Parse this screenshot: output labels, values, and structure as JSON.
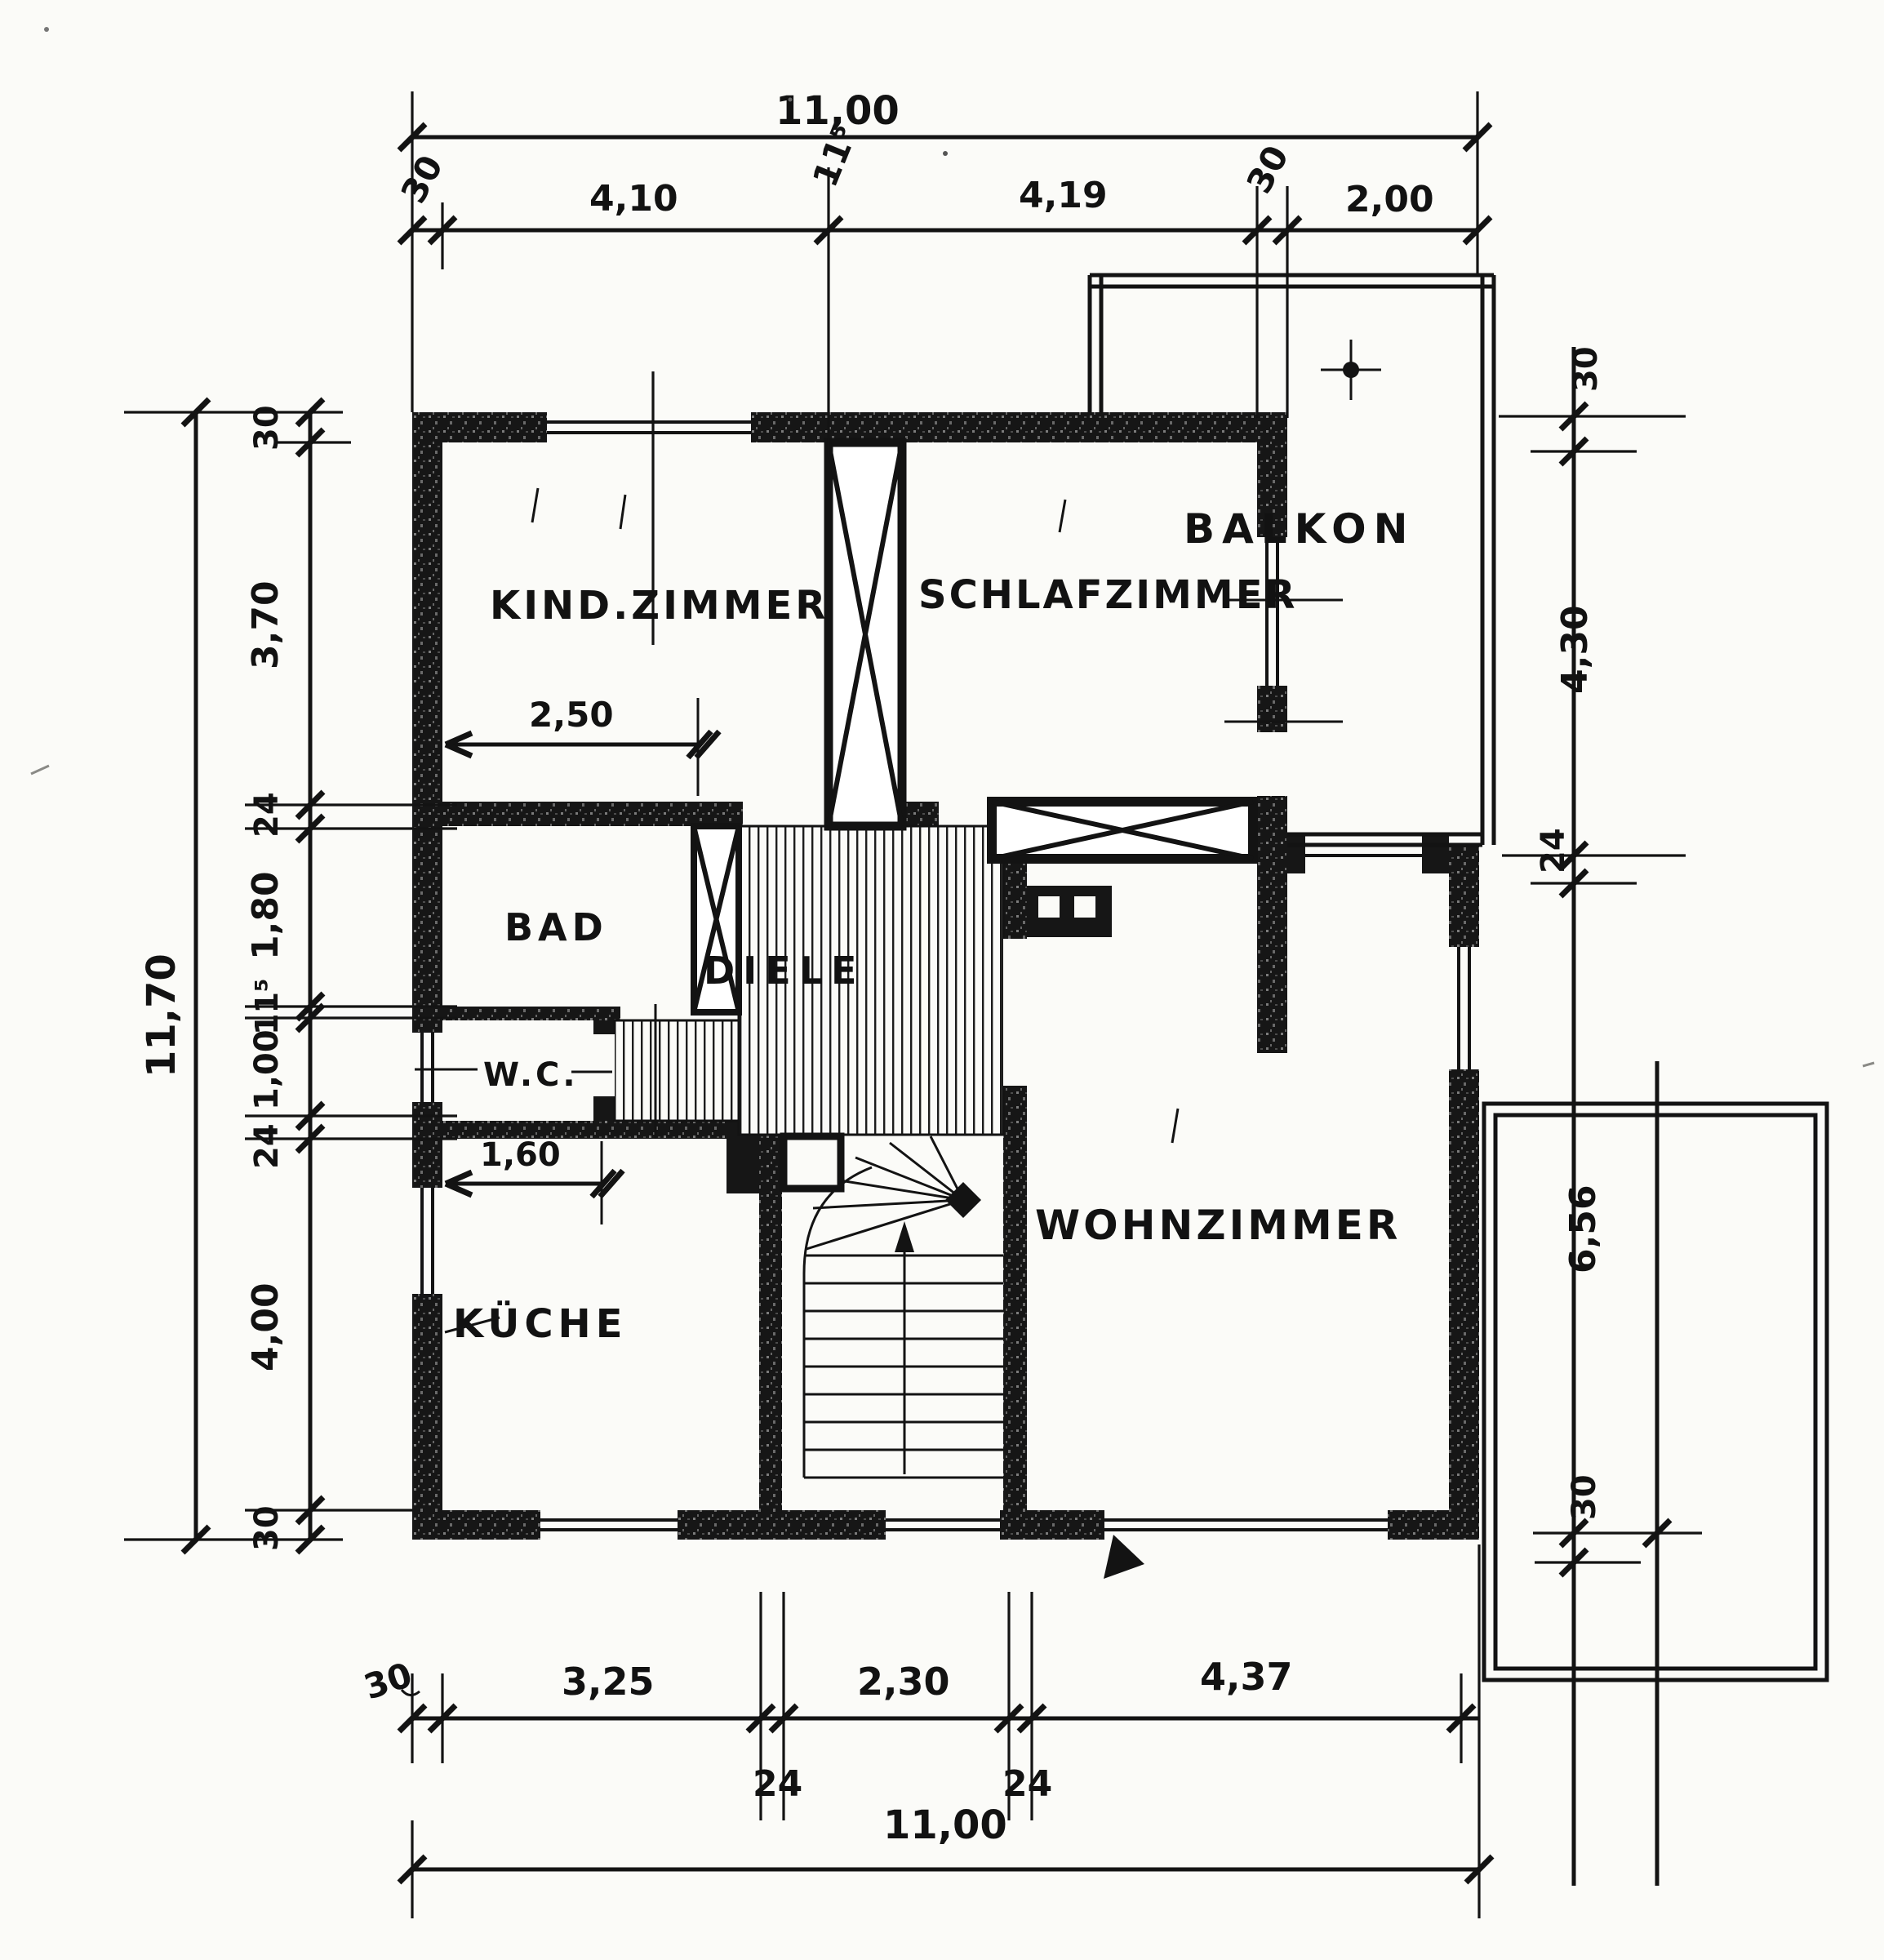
{
  "rooms": {
    "kind_zimmer": "KIND.ZIMMER",
    "schlafzimmer": "SCHLAFZIMMER",
    "balkon": "BALKON",
    "bad": "BAD",
    "wc": "W.C.",
    "diele": "DIELE",
    "kueche": "KÜCHE",
    "wohnzimmer": "WOHNZIMMER"
  },
  "dims": {
    "top": {
      "overall": "11,00",
      "wall_left": "30",
      "kind": "4,10",
      "partition": "11⁵",
      "schlaf": "4,19",
      "wall_right": "30",
      "balkon": "2,00"
    },
    "left": {
      "overall": "11,70",
      "wall_top": "30",
      "kind": "3,70",
      "w24a": "24",
      "bad": "1,80",
      "w115": "11⁵",
      "wc": "1,00",
      "w24b": "24",
      "kueche": "4,00",
      "wall_bottom": "30"
    },
    "right": {
      "parapet": "30",
      "balkon": "4,30",
      "w24": "24"
    },
    "terrace": {
      "length": "6,56",
      "w30": "30"
    },
    "bottom": {
      "wall_left": "30",
      "kueche": "3,25",
      "w24a": "24",
      "stair": "2,30",
      "w24b": "24",
      "wohn": "4,37",
      "overall": "11,00"
    },
    "interior": {
      "kind_width": "2,50",
      "kueche_niche": "1,60"
    }
  }
}
